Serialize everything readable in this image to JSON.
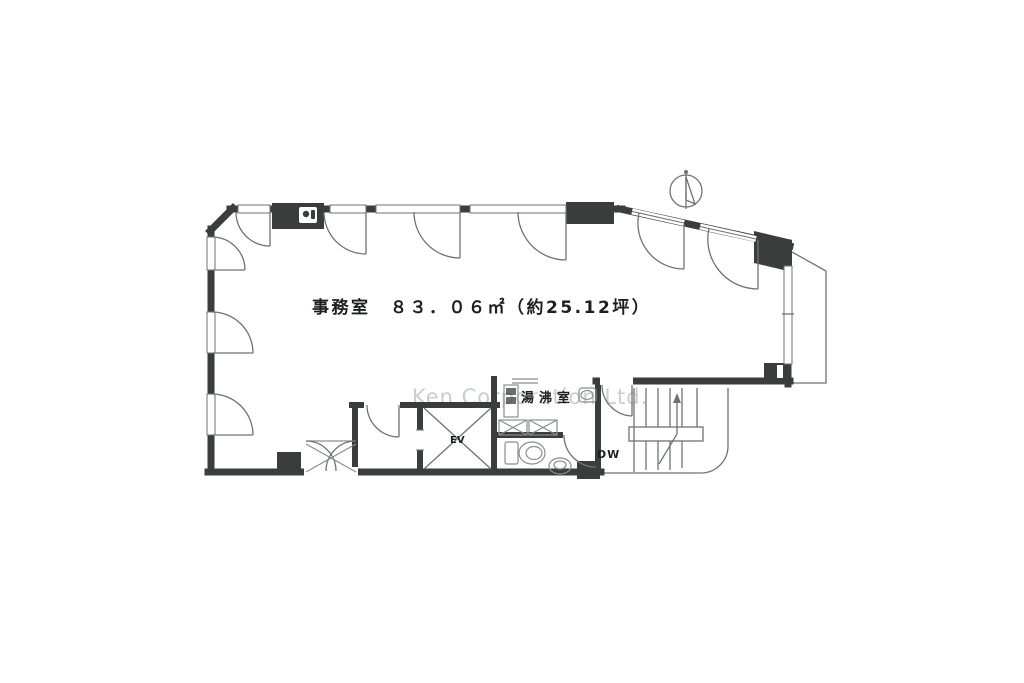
{
  "plan": {
    "room_label": "事務室　８３．０６㎡（約25.12坪）",
    "room_name": "事務室",
    "area_sqm": "83.06",
    "area_tsubo": "25.12",
    "kitchenette_label": "湯沸室",
    "elevator_label": "EV",
    "dumbwaiter_label": "DW",
    "watermark": "Ken Corporation Ltd."
  },
  "icons": {
    "north_indicator": "north-arrow-compass"
  },
  "colors": {
    "wall": "#3a3d3c",
    "line": "#6f7370",
    "fixture": "#8a8e8b",
    "ink": "#1e2020",
    "watermark": "#c9cfc9",
    "bg": "#ffffff"
  }
}
